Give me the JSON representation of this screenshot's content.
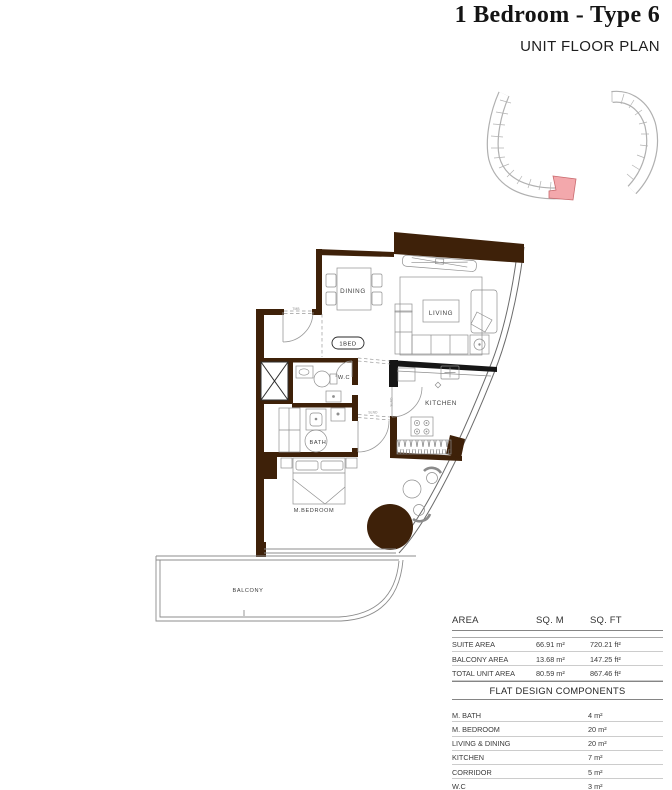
{
  "header": {
    "title": "1 Bedroom - Type 6",
    "subtitle": "UNIT FLOOR PLAN"
  },
  "colors": {
    "wall-color": "#3e2109",
    "highlight-fill": "#f3a8ac",
    "highlight-stroke": "#c96a6e"
  },
  "floor_plan": {
    "labels": {
      "dining": "DINING",
      "living": "LIVING",
      "unit_tag": "1BED",
      "wc": "W.C",
      "kitchen": "KITCHEN",
      "bath": "BATH",
      "bedroom": "M.BEDROOM",
      "balcony": "BALCONY"
    },
    "door_tags": {
      "entry": "TMB",
      "kitchen": "SLND",
      "corridor": "SLND"
    }
  },
  "area_table": {
    "headers": [
      "AREA",
      "SQ. M",
      "SQ. FT"
    ],
    "rows": [
      {
        "label": "SUITE AREA",
        "sqm": "66.91 m²",
        "sqft": "720.21 ft²"
      },
      {
        "label": "BALCONY AREA",
        "sqm": "13.68 m²",
        "sqft": "147.25 ft²"
      },
      {
        "label": "TOTAL UNIT AREA",
        "sqm": "80.59 m²",
        "sqft": "867.46 ft²"
      }
    ]
  },
  "components_table": {
    "title": "FLAT DESIGN COMPONENTS",
    "rows": [
      {
        "label": "M. BATH",
        "value": "4 m²"
      },
      {
        "label": "M. BEDROOM",
        "value": "20 m²"
      },
      {
        "label": "LIVING & DINING",
        "value": "20 m²"
      },
      {
        "label": "KITCHEN",
        "value": "7 m²"
      },
      {
        "label": "CORRIDOR",
        "value": "5 m²"
      },
      {
        "label": "W.C",
        "value": "3 m²"
      }
    ]
  }
}
